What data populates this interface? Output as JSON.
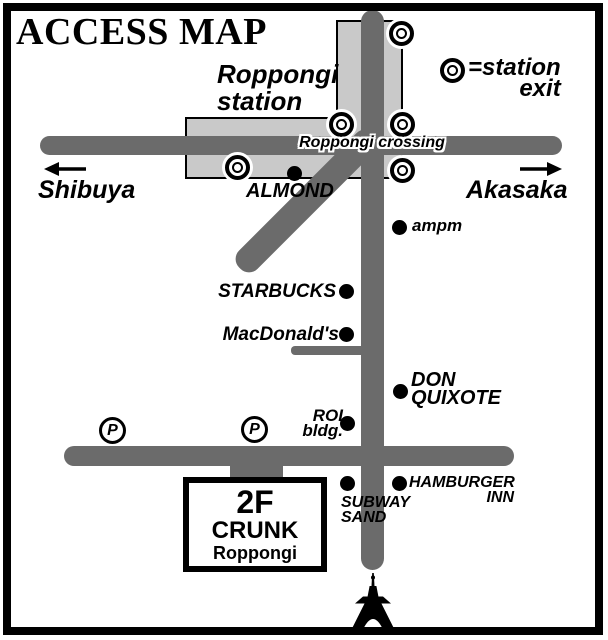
{
  "title": "ACCESS MAP",
  "colors": {
    "road": "#6b6b6b",
    "station_fill": "#c9c9c9",
    "ink": "#000000"
  },
  "legend": {
    "line1": "=station",
    "line2": "exit"
  },
  "station": {
    "line1": "Roppongi",
    "line2": "station"
  },
  "crossing": {
    "label": "Roppongi crossing"
  },
  "directions": {
    "west": "Shibuya",
    "east": "Akasaka"
  },
  "landmarks": {
    "almond": "ALMOND",
    "ampm": "ampm",
    "starbucks": "STARBUCKS",
    "macdonalds": "MacDonald's",
    "don_line1": "DON",
    "don_line2": "QUIXOTE",
    "roi_line1": "ROI",
    "roi_line2": "bldg.",
    "subway_line1": "SUBWAY",
    "subway_line2": "SAND",
    "hamburger_line1": "HAMBURGER",
    "hamburger_line2": "INN"
  },
  "parking": {
    "label": "P"
  },
  "destination": {
    "floor": "2F",
    "name": "CRUNK",
    "area": "Roppongi"
  }
}
